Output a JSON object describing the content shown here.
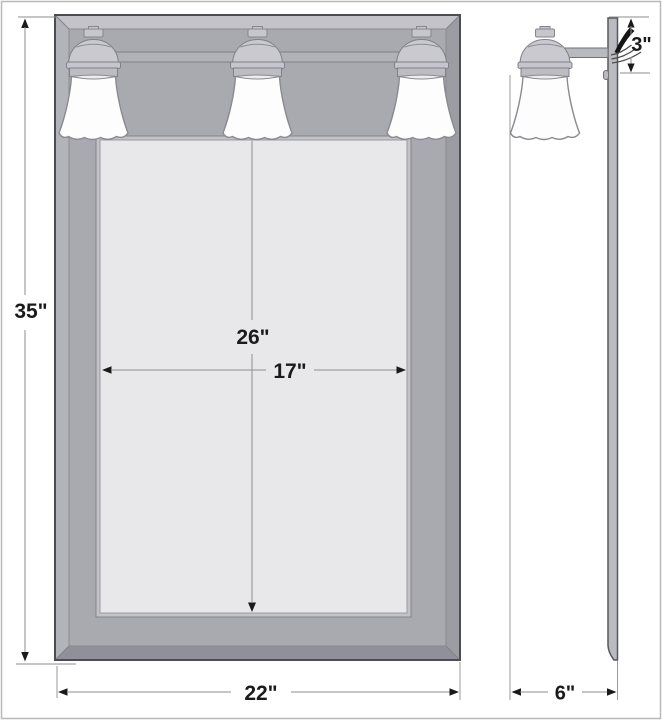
{
  "diagram": {
    "subject": "three-light vanity mirror medicine cabinet dimension drawing",
    "dimensions": {
      "overall_height": "35\"",
      "mirror_height": "26\"",
      "mirror_width": "17\"",
      "overall_width": "22\"",
      "side_depth": "6\"",
      "light_arm_offset": "3\""
    },
    "colors": {
      "frame_bevel": "#b7b7be",
      "frame_face": "#a9a9b0",
      "mirror_glass": "#e8e8eb",
      "lamp_shade": "#fdfdfe",
      "metal_trim": "#c9c9cf",
      "dimension_line": "#8e8e8e",
      "arrowhead": "#1a1a1a",
      "page_border": "#b9b9b9",
      "background": "#ffffff"
    }
  }
}
